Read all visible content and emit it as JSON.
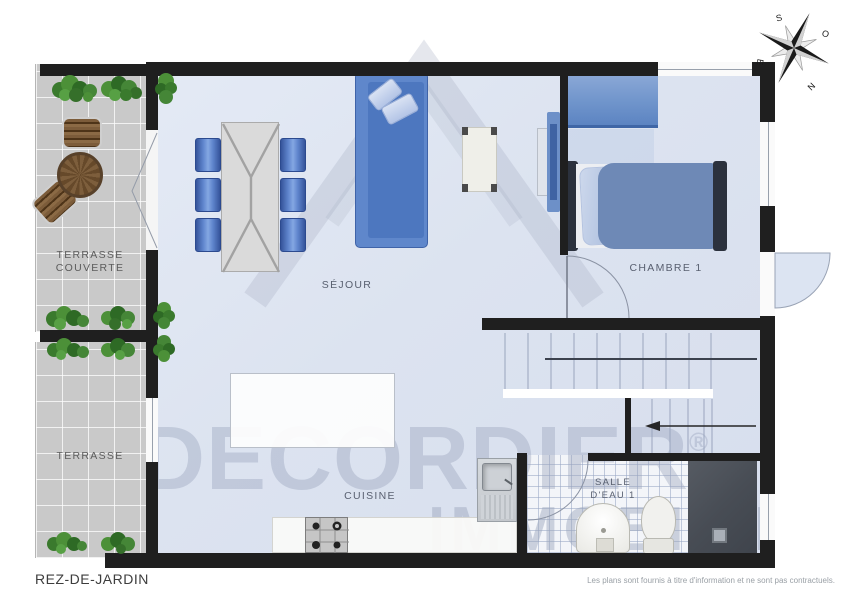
{
  "meta": {
    "floor_title": "REZ-DE-JARDIN",
    "disclaimer": "Les plans sont fournis à titre d'information et ne sont pas contractuels."
  },
  "watermark": {
    "brand": "DECORDIER",
    "registered": "®",
    "brand_line2": "IMMOBILIER"
  },
  "compass": {
    "north": "N",
    "south": "S",
    "east": "E",
    "west": "O"
  },
  "rooms": {
    "sejour": {
      "label": "SÉJOUR"
    },
    "chambre1": {
      "label": "CHAMBRE 1"
    },
    "cuisine": {
      "label": "CUISINE"
    },
    "salle_eau1": {
      "label_line1": "SALLE",
      "label_line2": "D'EAU 1"
    },
    "terrasse_couverte": {
      "label_line1": "TERRASSE",
      "label_line2": "COUVERTE"
    },
    "terrasse": {
      "label": "TERRASSE"
    }
  },
  "colors": {
    "floor": "#dce3f0",
    "terrace": "#c9c9c9",
    "wall": "#1f1f1f",
    "furniture_blue": "#5f87cb",
    "shower": "#4d525a"
  }
}
